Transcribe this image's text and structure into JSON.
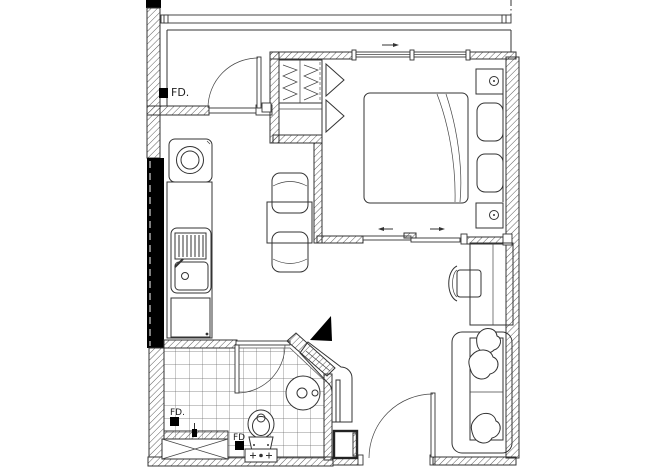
{
  "labels": {
    "fd_entry": "FD.",
    "fd_bathroom": "FD.",
    "fd_toilet": "FD"
  },
  "symbols": {
    "floor_drain": "filled-square",
    "window_slide_arrow": "arrow",
    "door_swing": "quarter-arc"
  },
  "colors": {
    "background": "#ffffff",
    "line": "#333333",
    "wall_fill": "#000000"
  }
}
